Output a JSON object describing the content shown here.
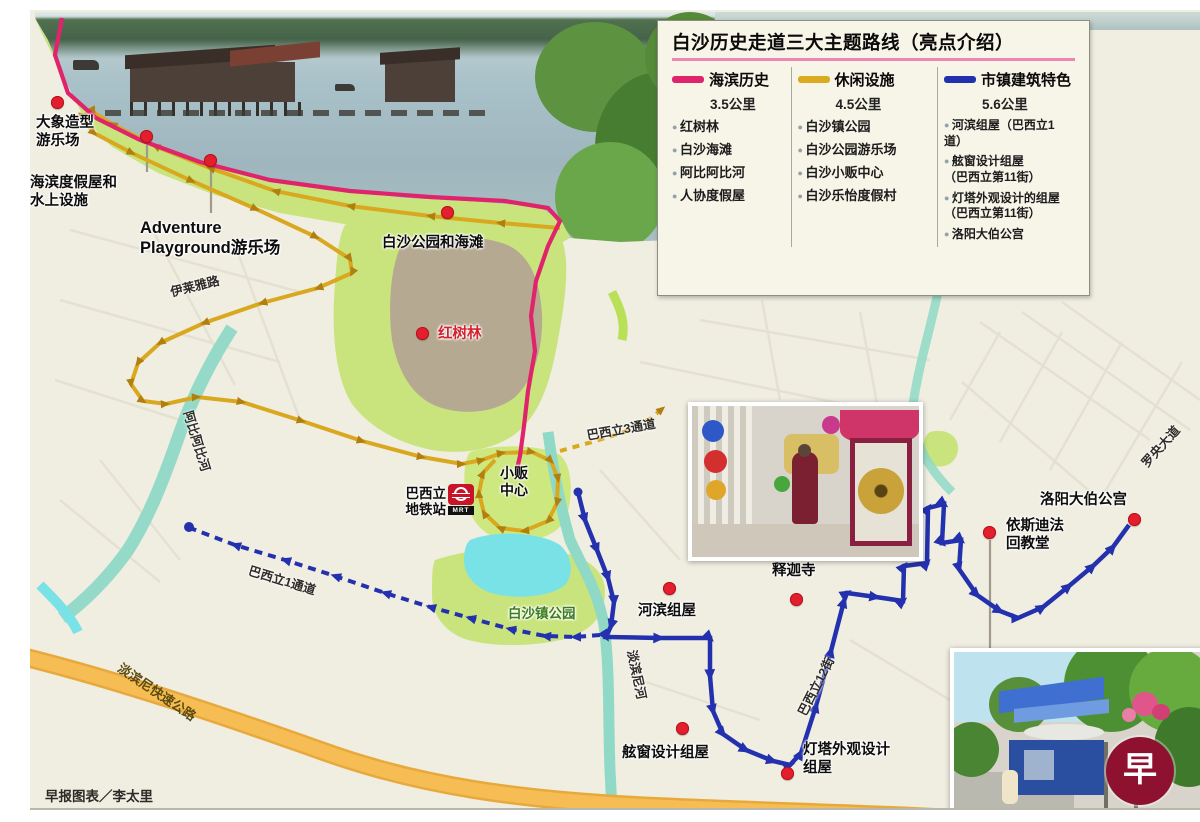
{
  "legend": {
    "title": "白沙历史走道三大主题路线（亮点介绍）",
    "routes": [
      {
        "name": "海滨历史",
        "distance": "3.5公里",
        "color": "#e0246b",
        "items": [
          "红树林",
          "白沙海滩",
          "阿比阿比河",
          "人协度假屋"
        ]
      },
      {
        "name": "休闲设施",
        "distance": "4.5公里",
        "color": "#dcaa1e",
        "items": [
          "白沙镇公园",
          "白沙公园游乐场",
          "白沙小贩中心",
          "白沙乐怡度假村"
        ]
      },
      {
        "name": "市镇建筑特色",
        "distance": "5.6公里",
        "color": "#2431ae",
        "items": [
          "河滨组屋（巴西立1道）",
          "舷窗设计组屋\n（巴西立第11街）",
          "灯塔外观设计的组屋\n（巴西立第11街）",
          "洛阳大伯公宫"
        ]
      }
    ]
  },
  "map": {
    "pois": {
      "elephant": "大象造型\n游乐场",
      "chalets": "海滨度假屋和\n水上设施",
      "adventure": "Adventure\nPlayground游乐场",
      "park_beach": "白沙公园和海滩",
      "mangrove": "红树林",
      "hawker": "小贩\n中心",
      "town_park": "白沙镇公园",
      "riverside_flats": "河滨组屋",
      "temple": "释迦寺",
      "porthole_flats": "舷窗设计组屋",
      "lighthouse_flats": "灯塔外观设计\n组屋",
      "mosque": "依斯迪法\n回教堂",
      "loyang_temple": "洛阳大伯公宫"
    },
    "station": {
      "name": "巴西立\n地铁站",
      "icon_text": "MRT"
    },
    "roads": {
      "elias": "伊莱雅路",
      "api_api": "阿比阿比河",
      "drive3": "巴西立3通道",
      "drive1": "巴西立1通道",
      "tampines_river": "淡滨尼河",
      "street12": "巴西立12街",
      "loyang_ave": "罗央大道",
      "tpe": "淡滨尼快速公路"
    },
    "route_colors": {
      "seaside": "#e0246b",
      "leisure": "#dcaa1e",
      "town": "#2431ae"
    },
    "logo_char": "早"
  },
  "credit": "早报图表／李太里"
}
